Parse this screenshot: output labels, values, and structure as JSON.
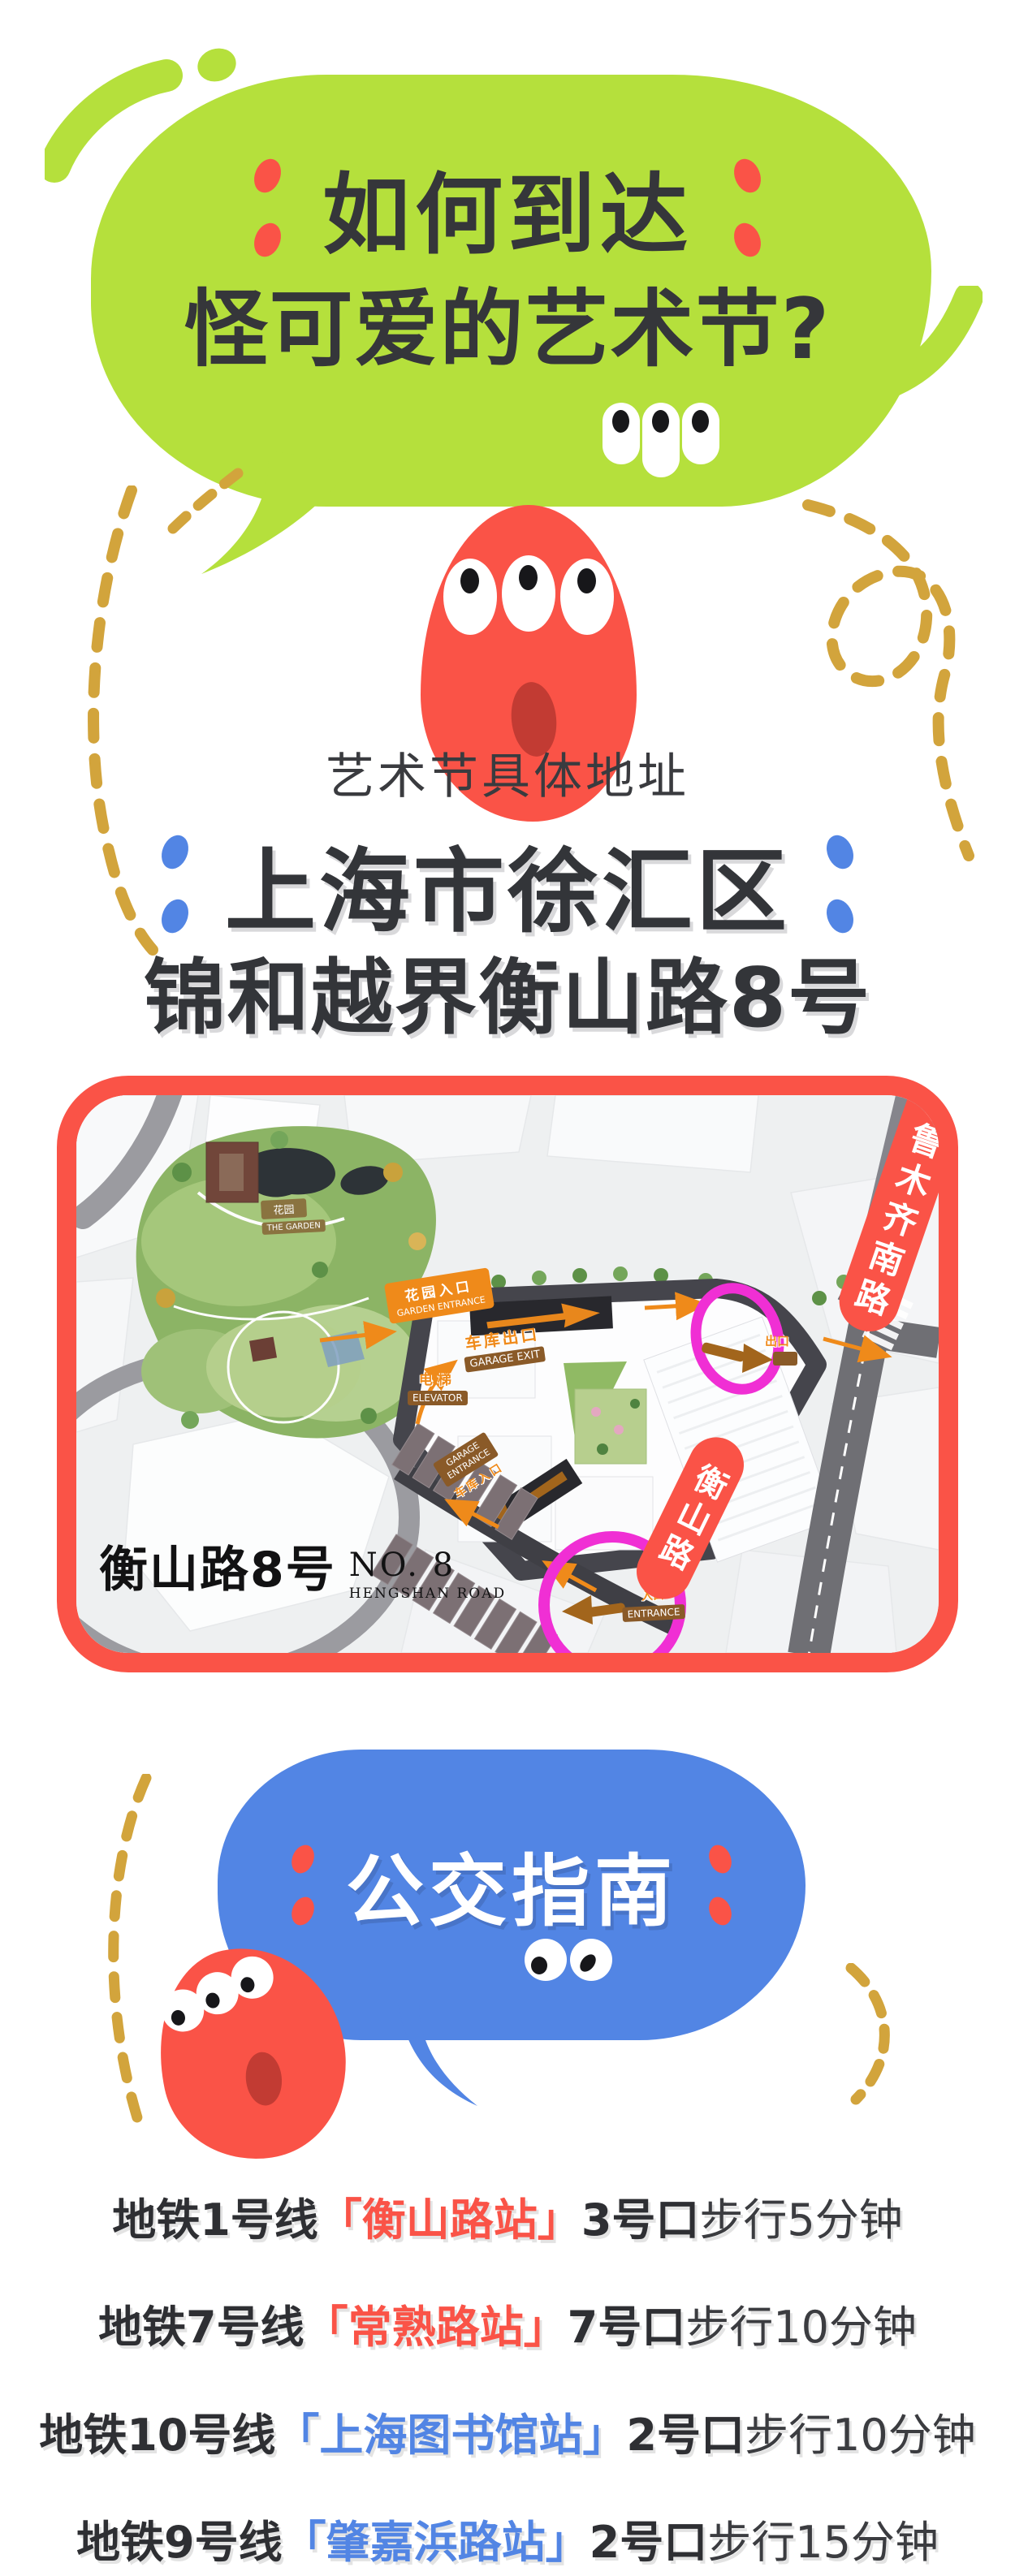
{
  "colors": {
    "green": "#b5e03c",
    "red": "#fa5347",
    "blue": "#5285e4",
    "gold": "#d2a43c",
    "magenta": "#f02fd4",
    "dark": "#35363a",
    "orange": "#ef8a1a",
    "brown": "#8a5a28"
  },
  "hero": {
    "line1": "如何到达",
    "line2": "怪可爱的艺术节?"
  },
  "address": {
    "label": "艺术节具体地址",
    "city": "上海市徐汇区",
    "venue": "锦和越界衡山路8号"
  },
  "map": {
    "logo": {
      "cn": "衡山路8号",
      "no": "NO. 8",
      "road": "HENGSHAN ROAD"
    },
    "labels": {
      "garden_cn": "花园",
      "garden_en": "THE GARDEN",
      "garden_entrance_cn": "花园入口",
      "garden_entrance_en": "GARDEN ENTRANCE",
      "garage_exit_cn": "车库出口",
      "garage_exit_en": "GARAGE EXIT",
      "elevator_cn": "电梯",
      "elevator_en": "ELEVATOR",
      "garage_entrance_cn": "车库入口",
      "garage_entrance_en1": "GARAGE",
      "garage_entrance_en2": "ENTRANCE",
      "exit_cn": "出口",
      "entrance_cn": "入口",
      "entrance_en": "ENTRANCE"
    },
    "banners": {
      "road1": "乌鲁木齐南路",
      "road2": "衡山路"
    }
  },
  "transit": {
    "title": "公交指南",
    "lines": [
      {
        "line": "地铁1号线",
        "station": "「衡山路站」",
        "exit": "3号口",
        "walk": "步行5分钟",
        "color": "#fa5347"
      },
      {
        "line": "地铁7号线",
        "station": "「常熟路站」",
        "exit": "7号口",
        "walk": "步行10分钟",
        "color": "#fa5347"
      },
      {
        "line": "地铁10号线",
        "station": "「上海图书馆站」",
        "exit": "2号口",
        "walk": "步行10分钟",
        "color": "#5285e4"
      },
      {
        "line": "地铁9号线",
        "station": "「肇嘉浜路站」",
        "exit": "2号口",
        "walk": "步行15分钟",
        "color": "#5285e4"
      }
    ]
  }
}
